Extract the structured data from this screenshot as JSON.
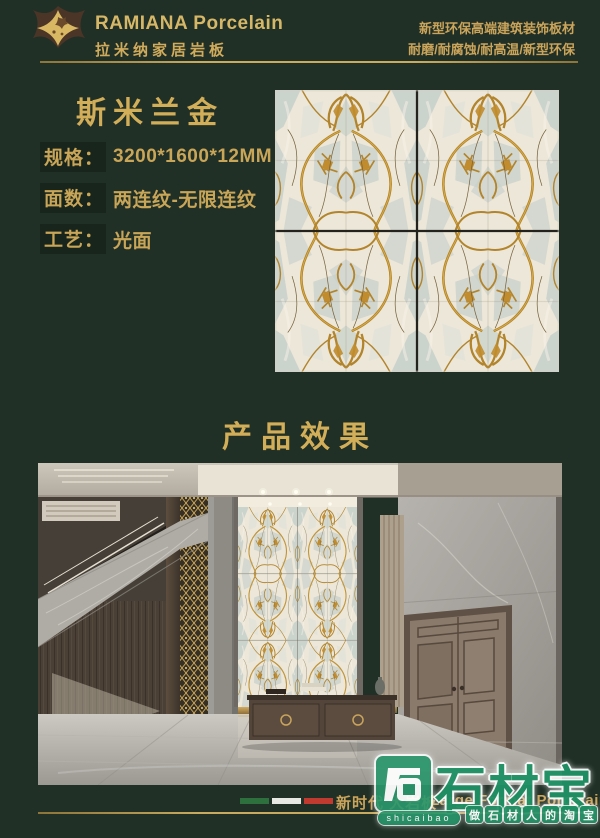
{
  "brand": {
    "name": "RAMIANA Porcelain",
    "name_cn": "拉米纳家居岩板"
  },
  "tagline": {
    "line1": "新型环保高端建筑装饰板材",
    "line2": "耐磨/耐腐蚀/耐高温/新型环保"
  },
  "product": {
    "name": "斯米兰金",
    "specs": [
      {
        "label": "规格：",
        "value": "3200*1600*12MM"
      },
      {
        "label": "面数：",
        "value": "两连纹-无限连纹"
      },
      {
        "label": "工艺：",
        "value": "光面"
      }
    ]
  },
  "section": {
    "effect_title": "产品效果"
  },
  "footer": {
    "flag_colors": [
      "#2e6f3e",
      "#e7e7e3",
      "#c03a2f"
    ],
    "text_cn": "新时代 大岩板",
    "text_en": "Large Format Porcelain Tiles"
  },
  "watermark": {
    "name": "石材宝",
    "pinyin": "shicaibao",
    "slogan_chars": [
      "做",
      "石",
      "材",
      "人",
      "的",
      "淘",
      "宝"
    ],
    "green": "#1f9165"
  },
  "colors": {
    "background": "#203026",
    "gold_text": "#c9a557",
    "gold_line": "#b5974d",
    "marble": {
      "base": "#ece7d8",
      "grey": "#c6cfcb",
      "grey_light": "#d9e0da",
      "highlight": "#f8f4e8",
      "vein": "#b2842c",
      "vein_fill": "#c08c2e",
      "vein_bright": "#dcae46",
      "vein_dark": "#76603a",
      "seam": "#23221d"
    }
  }
}
